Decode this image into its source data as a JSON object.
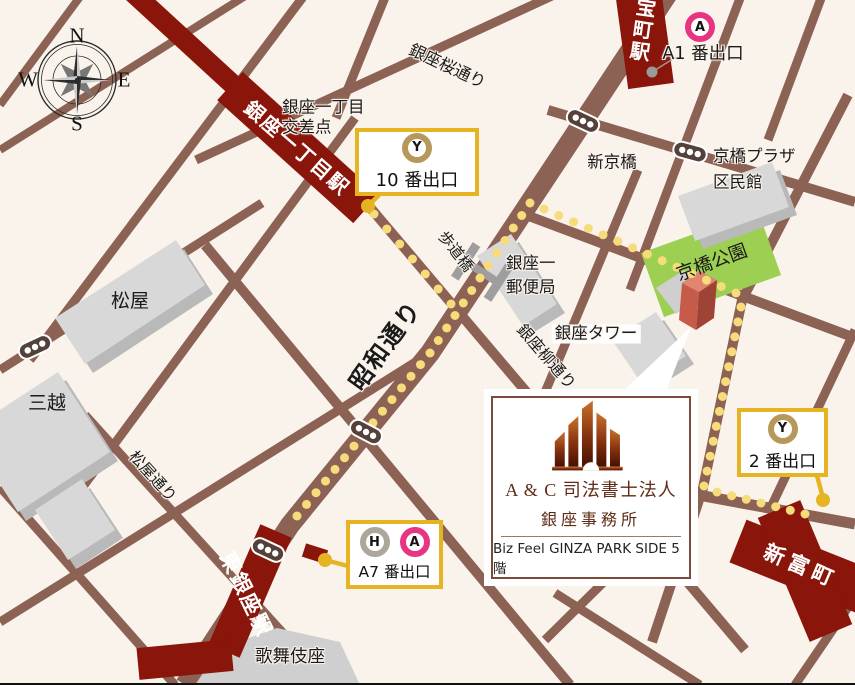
{
  "compass": {
    "north": "N",
    "south": "S",
    "east": "E",
    "west": "W"
  },
  "stations": {
    "ginza_itchome": "銀座一丁目駅",
    "takaracho": "宝町駅",
    "higashi_ginza": "東銀座駅",
    "shintomicho": "新富町"
  },
  "exits": {
    "a1": {
      "label": "A1 番出口",
      "badges": [
        "A"
      ]
    },
    "exit10": {
      "label": "10 番出口",
      "badges": [
        "Y"
      ]
    },
    "exit2": {
      "label": "2 番出口",
      "badges": [
        "Y"
      ]
    },
    "a7": {
      "label": "A7 番出口",
      "badges": [
        "H",
        "A"
      ]
    }
  },
  "badges": {
    "Y": {
      "letter": "Y",
      "color": "#B5985A"
    },
    "A": {
      "letter": "A",
      "color": "#E73581"
    },
    "H": {
      "letter": "H",
      "color": "#ACA79A"
    }
  },
  "streets": {
    "showa_dori": "昭和通り",
    "sakura_dori": "銀座桜通り",
    "yanagi_dori": "銀座柳通り",
    "matsuya_dori": "松屋通り",
    "hodokyo": "歩道橋"
  },
  "places": {
    "crossing_line1": "銀座一丁目",
    "crossing_line2": "交差点",
    "shinkyobashi": "新京橋",
    "kyobashi_plaza_line1": "京橋プラザ",
    "kyobashi_plaza_line2": "区民館",
    "kyobashi_park": "京橋公園",
    "matsuya": "松屋",
    "mitsukoshi": "三越",
    "post_office_line1": "銀座一",
    "post_office_line2": "郵便局",
    "ginza_tower": "銀座タワー",
    "kabukiza": "歌舞伎座"
  },
  "office": {
    "name": "A & C 司法書士法人",
    "branch": "銀座事務所",
    "building": "Biz Feel GINZA PARK SIDE 5階"
  },
  "colors": {
    "background": "#FAF3EC",
    "road": "#8C6254",
    "rail": "#8A150B",
    "route_dots": "#F6DC7A",
    "accent_yellow": "#E6B422",
    "park_green": "#9CCF52",
    "dest_building": "#C75B49"
  }
}
